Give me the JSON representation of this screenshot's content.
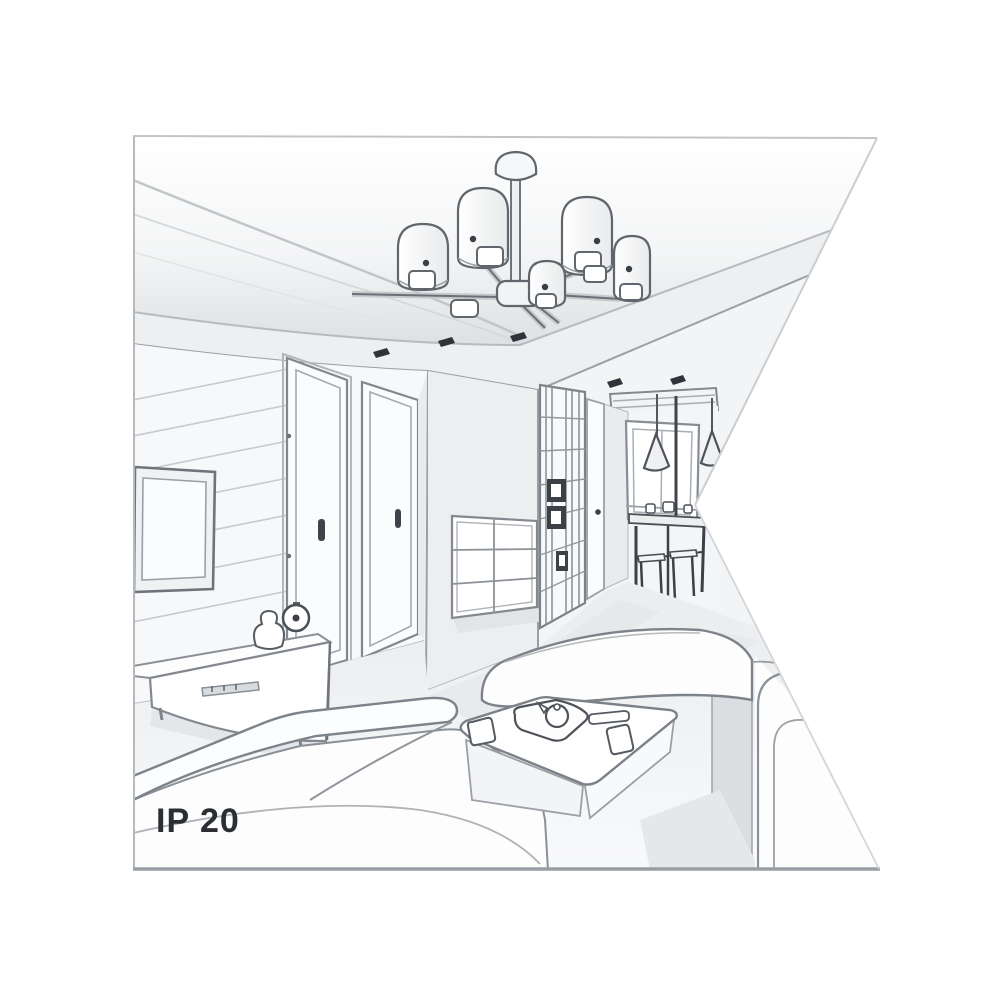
{
  "page": {
    "background_color": "#ffffff"
  },
  "illustration": {
    "ip_rating_label": "IP 20",
    "text_color": "#2b2f33",
    "sketch_line_color": "#7d838a",
    "sketch_dark_color": "#3c4147",
    "sketch_light_color": "#c6c9cc",
    "wall_color": "#f3f4f6",
    "ceiling_shade_color": "#dfe2e4",
    "floor_shadow_color": "#e5e8ea"
  }
}
